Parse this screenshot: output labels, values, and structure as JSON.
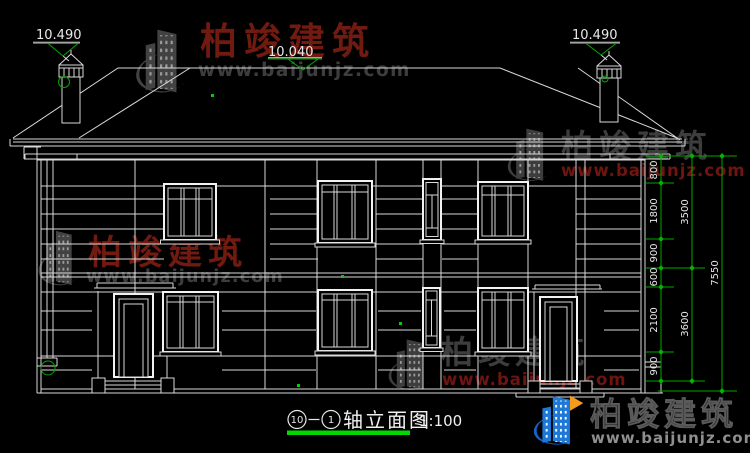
{
  "drawing": {
    "elevations": {
      "left": "10.490",
      "center": "10.040",
      "right": "10.490"
    },
    "dimensions": {
      "inner": [
        "800",
        "1800",
        "900",
        "600",
        "2100",
        "900"
      ],
      "middle": [
        "3500",
        "3600"
      ],
      "outer": [
        "7550"
      ]
    },
    "title": {
      "axis_start": "10",
      "axis_sep": "—",
      "axis_end": "1",
      "name": "轴立面图",
      "scale": "1:100"
    }
  },
  "watermark": {
    "brand": "柏竣建筑",
    "url": "www.baijunjz.com"
  },
  "colors": {
    "line": "#d9d9d9",
    "dim_green": "#00a800",
    "bright_green": "#00d800",
    "watermark_red": "#701a10",
    "watermark_gray": "#3d3d3d",
    "logo_blue": "#1e78d7",
    "logo_orange": "#f59a1f"
  }
}
